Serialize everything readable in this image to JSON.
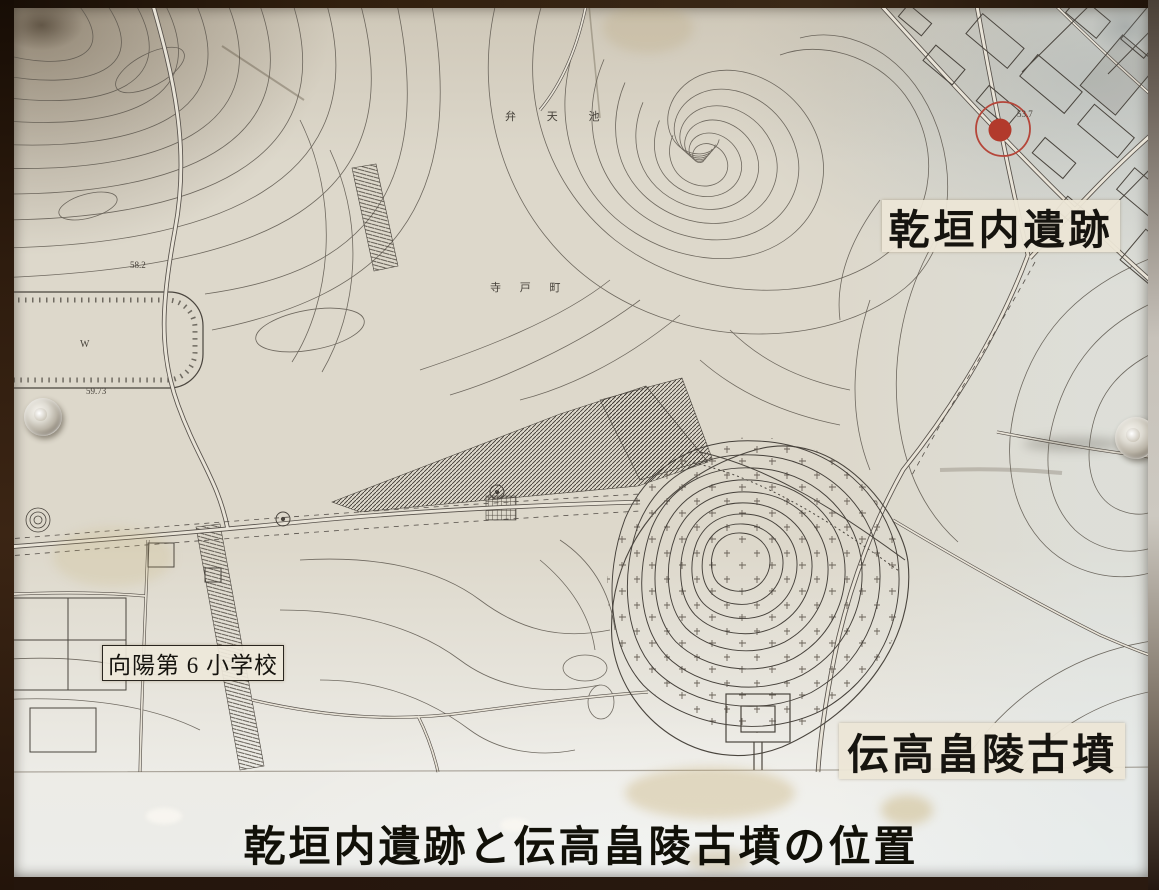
{
  "board": {
    "title": "乾垣内遺跡と伝高畠陵古墳の位置",
    "labels": {
      "site": "乾垣内遺跡",
      "kofun": "伝高畠陵古墳",
      "school": "向陽第 6 小学校"
    },
    "map_text": {
      "pond_name": "弁 天 池",
      "district_name": "寺 戸 町",
      "spot_height_1": "58.2",
      "spot_height_2": "59.73",
      "spot_height_3": "53.7",
      "well_mark": "W"
    },
    "colors": {
      "marker_red": "#b23a2c",
      "paper": "#ded9cc",
      "frame_wood": "#2a1a10",
      "map_line": "#5b554c",
      "label_paper": "#ece6d6",
      "text_black": "#16140f"
    }
  }
}
